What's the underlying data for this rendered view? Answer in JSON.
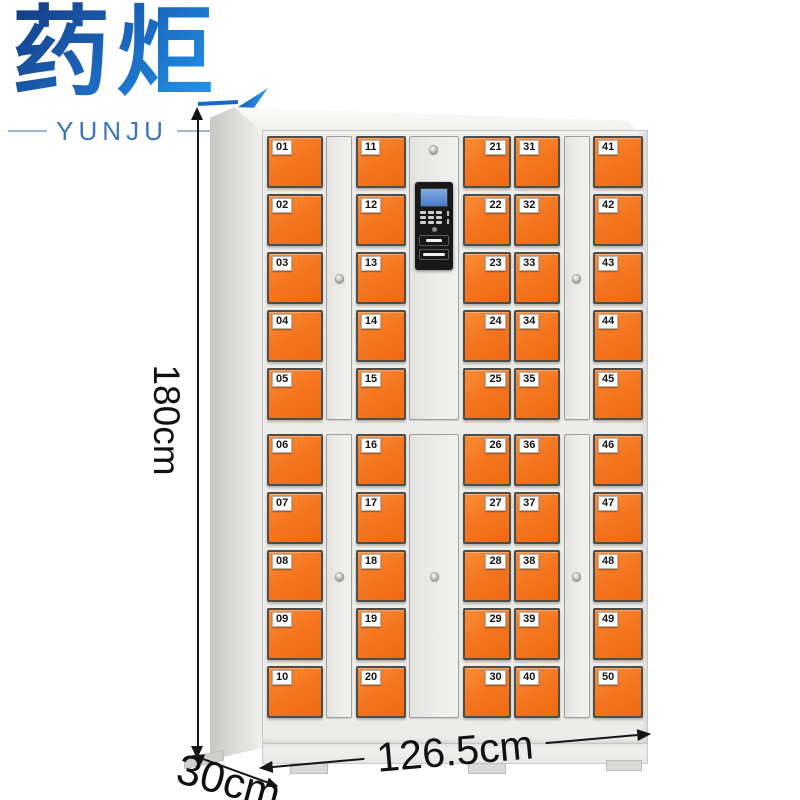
{
  "brand": {
    "name": "药炬",
    "latin": "YUNJU"
  },
  "dimensions": {
    "height": "180cm",
    "width": "126.5cm",
    "depth": "30cm"
  },
  "cabinet": {
    "body_color": "#ececea",
    "door_color": "#f4741f",
    "columns": [
      {
        "type": "doors",
        "label_side": "left",
        "numbers": [
          "01",
          "02",
          "03",
          "04",
          "05",
          "06",
          "07",
          "08",
          "09",
          "10"
        ]
      },
      {
        "type": "panel"
      },
      {
        "type": "doors",
        "label_side": "left",
        "numbers": [
          "11",
          "12",
          "13",
          "14",
          "15",
          "16",
          "17",
          "18",
          "19",
          "20"
        ]
      },
      {
        "type": "control"
      },
      {
        "type": "doors",
        "label_side": "right",
        "numbers": [
          "21",
          "22",
          "23",
          "24",
          "25",
          "26",
          "27",
          "28",
          "29",
          "30"
        ]
      },
      {
        "type": "doors",
        "label_side": "left",
        "numbers": [
          "31",
          "32",
          "33",
          "34",
          "35",
          "36",
          "37",
          "38",
          "39",
          "40"
        ]
      },
      {
        "type": "panel"
      },
      {
        "type": "doors",
        "label_side": "left",
        "numbers": [
          "41",
          "42",
          "43",
          "44",
          "45",
          "46",
          "47",
          "48",
          "49",
          "50"
        ]
      }
    ],
    "control_panel": {
      "parts": [
        "lcd-screen",
        "keypad",
        "indicator-lights",
        "speaker",
        "card-slot",
        "receipt-slot"
      ]
    }
  },
  "colors": {
    "logo_blue_dark": "#143e86",
    "logo_blue_light": "#2196eb",
    "accent_orange": "#f4741f",
    "annotation_black": "#151515"
  }
}
